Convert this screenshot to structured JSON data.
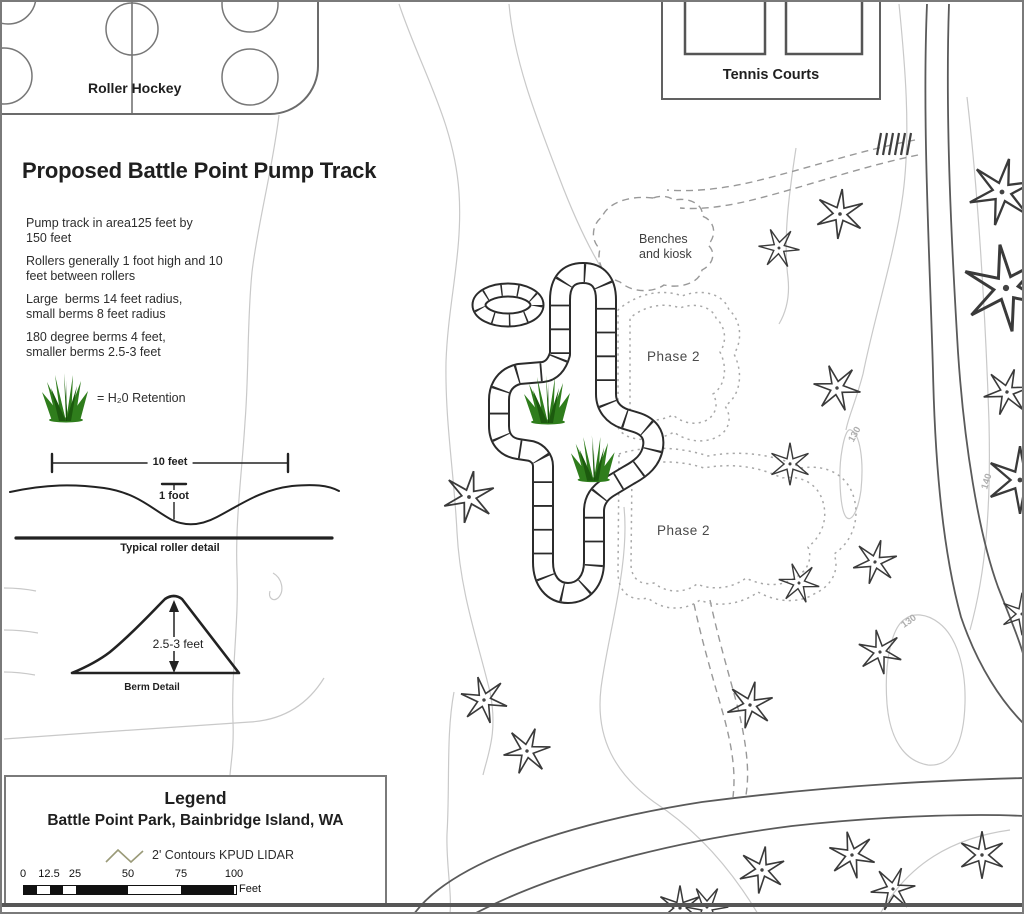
{
  "map": {
    "title": "Proposed Battle Point Pump Track",
    "roller_hockey_label": "Roller Hockey",
    "tennis_courts_label": "Tennis Courts",
    "benches_kiosk_label": "Benches\nand kiosk",
    "water_retention_label": "= H₂0 Retention",
    "notes": [
      "Pump track in area125 feet by\n150 feet",
      "Rollers generally 1 foot high and 10\nfeet between rollers",
      "Large  berms 14 feet radius,\nsmall berms 8 feet radius",
      "180 degree berms 4 feet,\nsmaller berms 2.5-3 feet"
    ],
    "phase2_labels": {
      "upper": "Phase 2",
      "lower": "Phase 2"
    },
    "contour_values": {
      "upper": "130",
      "right": "140",
      "lower": "130"
    }
  },
  "roller_detail": {
    "width_label": "10 feet",
    "height_label": "1 foot",
    "caption": "Typical roller detail"
  },
  "berm_detail": {
    "height_label": "2.5-3 feet",
    "caption": "Berm Detail"
  },
  "legend": {
    "heading": "Legend",
    "location": "Battle Point Park, Bainbridge Island, WA",
    "contour_symbol_label": "2' Contours KPUD LIDAR",
    "scale_bar": {
      "ticks": [
        "0",
        "12.5",
        "25",
        "50",
        "75",
        "100"
      ],
      "unit": "Feet"
    }
  },
  "colors": {
    "grass_green": "#2f7d1c",
    "grass_dark": "#1c5a0e",
    "contour_gray": "#c9c9c9",
    "drawing_black": "#2b2b2b",
    "road_gray": "#5a5a5a"
  }
}
